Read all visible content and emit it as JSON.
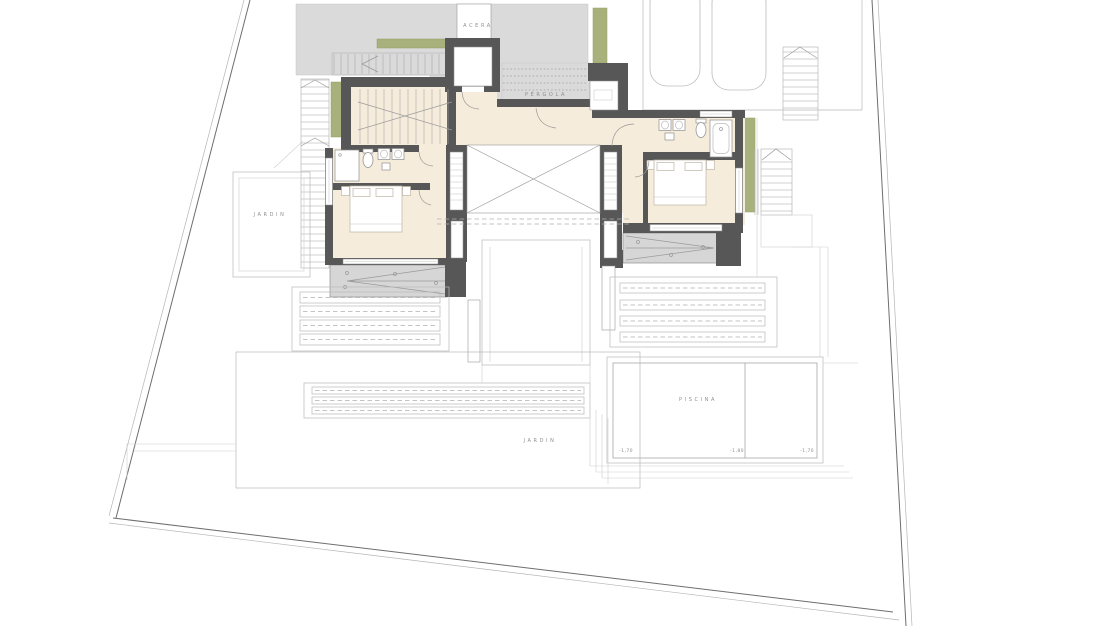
{
  "page": {
    "type": "architectural-floor-plan",
    "background": "#ffffff"
  },
  "labels": {
    "sidewalk": "ACERA",
    "pergola": "PÉRGOLA",
    "garden_side": "JARDIN",
    "garden_lower": "JARDIN",
    "pool": "PISCINA"
  },
  "pool_levels": {
    "left": "-1,70",
    "middle": "-1,80",
    "right": "-1,70"
  },
  "palette": {
    "paving_gray": "#dadada",
    "floor_cream": "#f6ecdb",
    "wall_dark": "#575757",
    "planting_green": "#a8b17b",
    "balcony_gray": "#d6d6d6",
    "line_gray": "#9a9a9a"
  }
}
